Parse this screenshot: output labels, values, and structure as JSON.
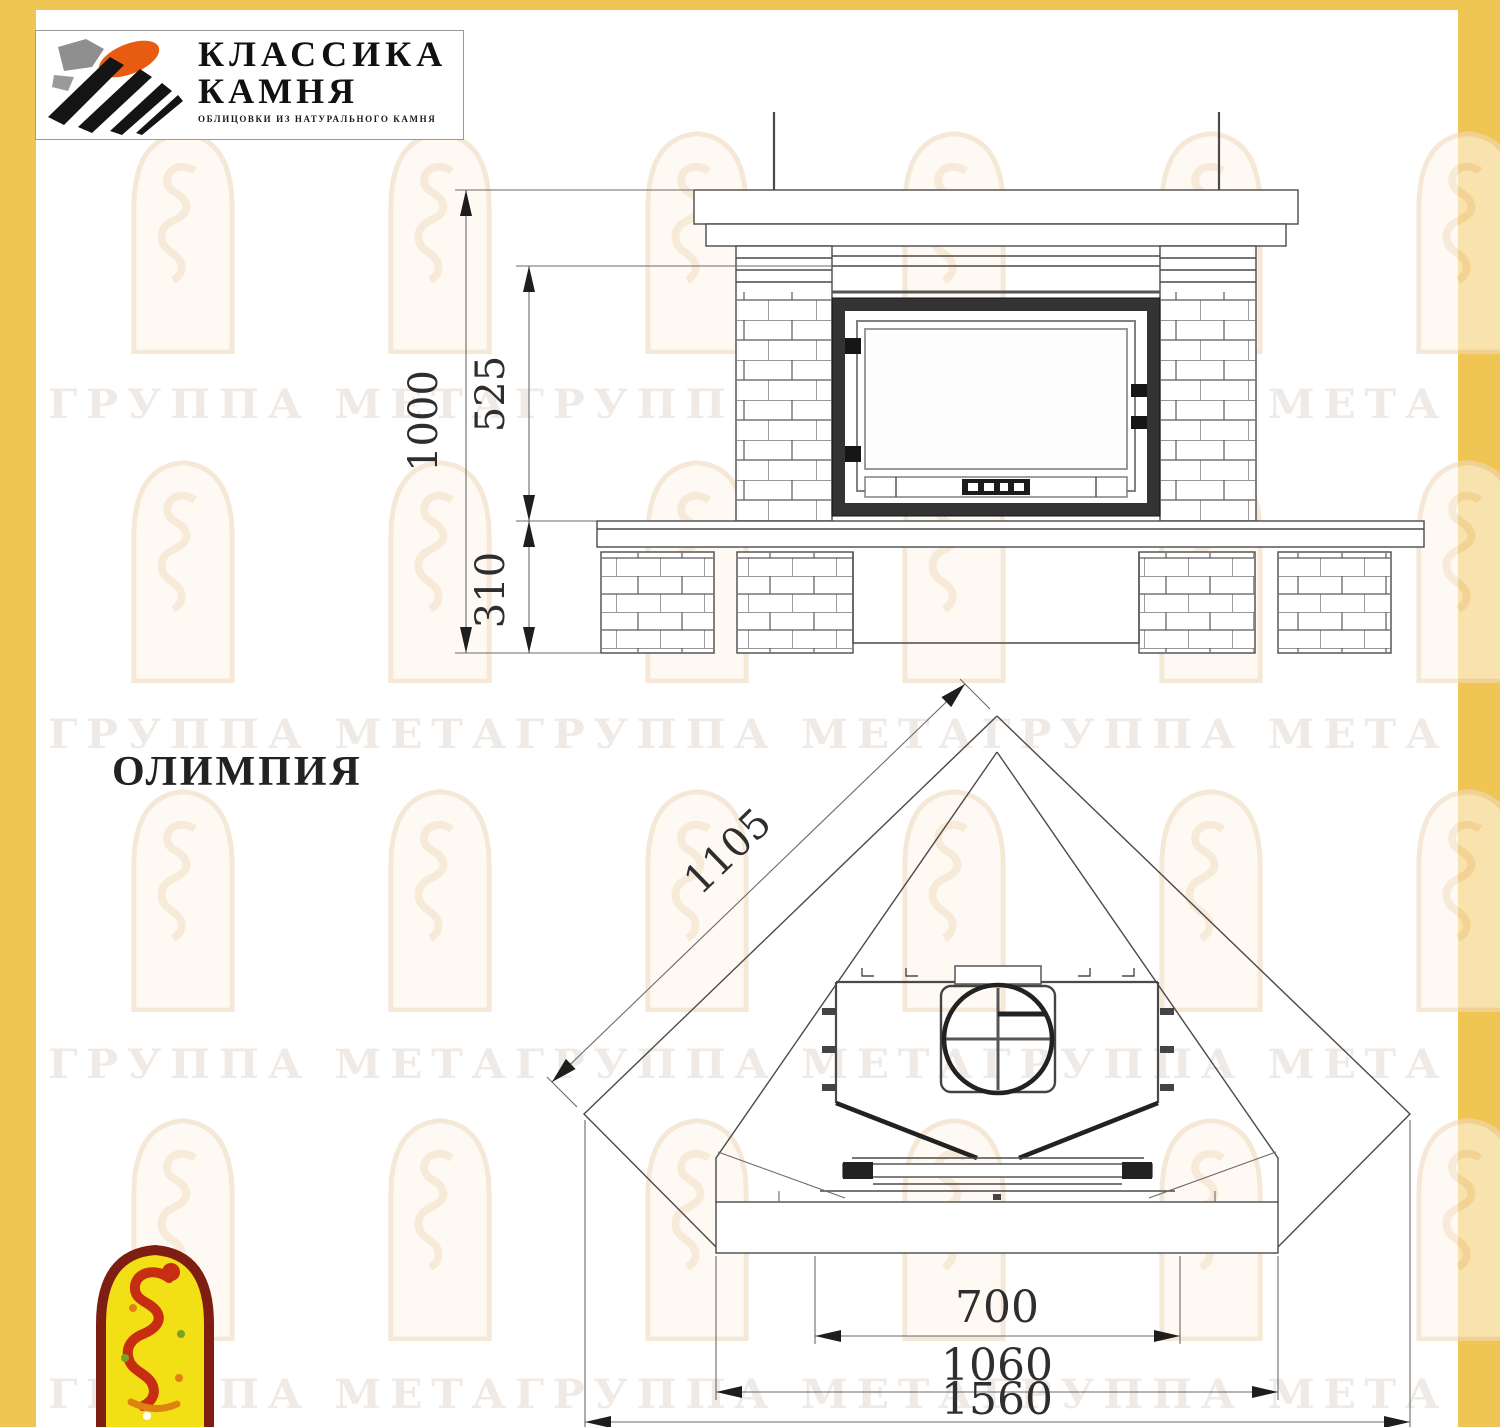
{
  "logo": {
    "line1": "КЛАССИКА",
    "line2": "КАМНЯ",
    "tagline": "ОБЛИЦОВКИ ИЗ НАТУРАЛЬНОГО КАМНЯ"
  },
  "title": "ОЛИМПИЯ",
  "watermark": {
    "text": "ГРУППА МЕТАГРУППА МЕТАГРУППА МЕТА"
  },
  "front_view": {
    "dims": {
      "total_height": "1000",
      "opening_height": "525",
      "base_height": "310"
    }
  },
  "plan_view": {
    "dims": {
      "side_depth": "1105",
      "opening_width": "700",
      "bench_width": "1060",
      "total_width": "1560"
    }
  },
  "colors": {
    "accent_bar": "#efc654",
    "line": "#4a4a4a",
    "firebox_frame": "#333333",
    "logo_orange": "#e85c12",
    "logo_black": "#141414",
    "badge_yellow": "#f3df16",
    "badge_red": "#c62d12",
    "badge_border": "#7e1d12"
  }
}
